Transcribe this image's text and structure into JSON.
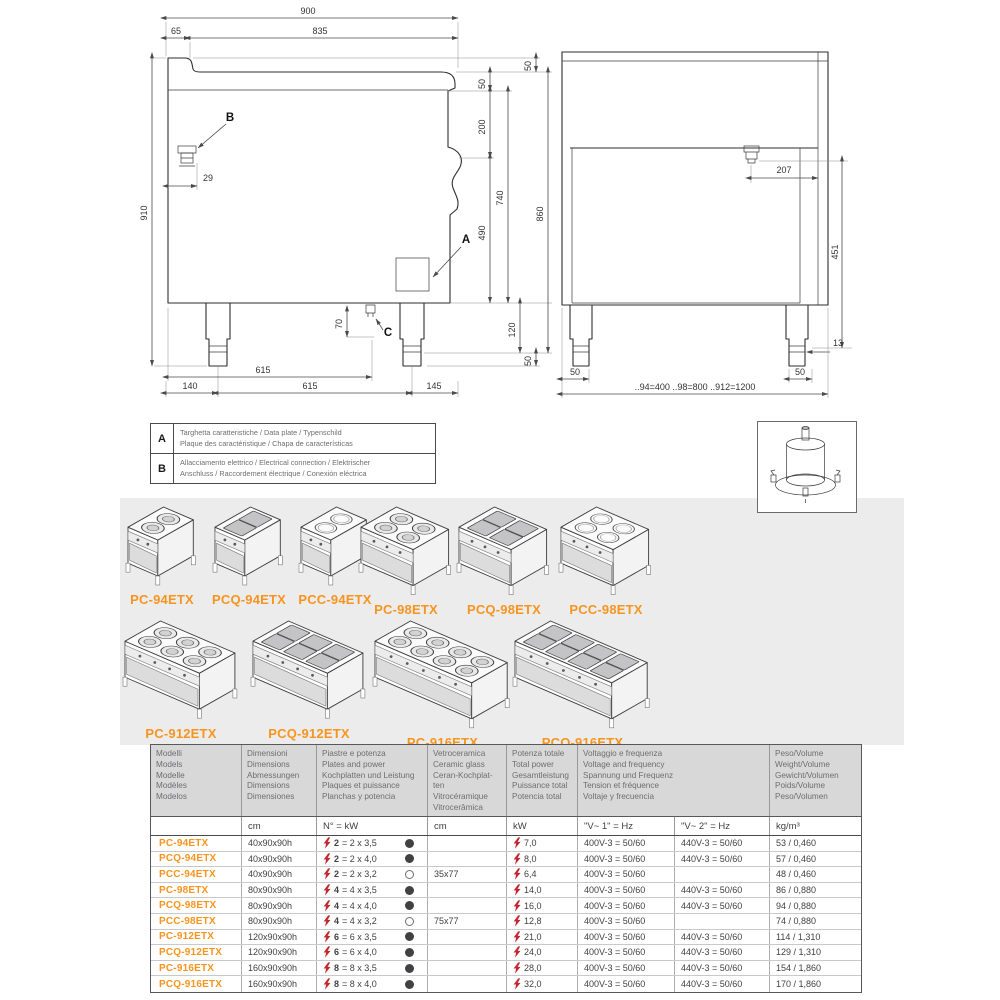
{
  "drawing_left": {
    "dim_900": "900",
    "dim_65": "65",
    "dim_835": "835",
    "dim_910": "910",
    "dim_50_top": "50",
    "dim_50_front": "50",
    "dim_200": "200",
    "dim_490": "490",
    "dim_740": "740",
    "dim_860": "860",
    "dim_120": "120",
    "dim_50_bottom": "50",
    "dim_29": "29",
    "dim_70": "70",
    "dim_615_inner": "615",
    "dim_140": "140",
    "dim_615": "615",
    "dim_145": "145",
    "label_a": "A",
    "label_b": "B",
    "label_c": "C"
  },
  "drawing_right": {
    "dim_207": "207",
    "dim_451": "451",
    "dim_13": "13",
    "dim_50_left": "50",
    "dim_50_right": "50",
    "dim_widths": "..94=400 ..98=800 ..912=1200"
  },
  "legend": {
    "rows": [
      {
        "key": "A",
        "line1": "Targhetta caratteristiche / Data plate / Typenschild",
        "line2": "Plaque des caractéristique / Chapa de características"
      },
      {
        "key": "B",
        "line1": "Allacciamento elettrico / Electrical connection / Elektrischer",
        "line2": "Anschluss / Raccordement électrique / Conexión eléctrica"
      }
    ]
  },
  "products": {
    "row1": [
      {
        "name": "PC-94ETX",
        "cols": 1,
        "shape": "round"
      },
      {
        "name": "PCQ-94ETX",
        "cols": 1,
        "shape": "square"
      },
      {
        "name": "PCC-94ETX",
        "cols": 1,
        "shape": "ceramic"
      },
      {
        "name": "PC-98ETX",
        "cols": 2,
        "shape": "round"
      },
      {
        "name": "PCQ-98ETX",
        "cols": 2,
        "shape": "square"
      },
      {
        "name": "PCC-98ETX",
        "cols": 2,
        "shape": "ceramic"
      }
    ],
    "row2": [
      {
        "name": "PC-912ETX",
        "cols": 3,
        "shape": "round"
      },
      {
        "name": "PCQ-912ETX",
        "cols": 3,
        "shape": "square"
      },
      {
        "name": "PC-916ETX",
        "cols": 4,
        "shape": "round"
      },
      {
        "name": "PCQ-916ETX",
        "cols": 4,
        "shape": "square"
      }
    ]
  },
  "table": {
    "headers": {
      "models": "Modelli\nModels\nModelle\nModèles\nModelos",
      "dimensions": "Dimensioni\nDimensions\nAbmessungen\nDimensions\nDimensiones",
      "plates": "Piastre e potenza\nPlates and power\nKochplatten und Leistung\nPlaques et puissance\nPlanchas y potencia",
      "ceramic": "Vetroceramica\nCeramic glass\nCeran-Kochplat-\nten\nVitrocéramique\nVitrocerâmica",
      "power": "Potenza totale\nTotal power\nGesamtleistung\nPuissance total\nPotencia total",
      "voltage": "Voltaggio e frequenza\nVoltage and frequency\nSpannung und Frequenz\nTension et fréquence\nVoltaje y frecuencia",
      "weight": "Peso/Volume\nWeight/Volume\nGewicht/Volumen\nPoids/Volume\nPeso/Volumen"
    },
    "units": {
      "model": "",
      "dim": "cm",
      "plates": "N° = kW",
      "ceramic": "cm",
      "power": "kW",
      "v1": "\"V~ 1\" = Hz",
      "v2": "\"V~ 2\" = Hz",
      "weight": "kg/m³"
    },
    "rows": [
      {
        "model": "PC-94ETX",
        "dim": "40x90x90h",
        "plates_n": "2",
        "plates_detail": "= 2 x 3,5",
        "plate_type": "filled",
        "ceramic": "",
        "power": "7,0",
        "v1": "400V-3 = 50/60",
        "v2": "440V-3 = 50/60",
        "weight": "53 / 0,460"
      },
      {
        "model": "PCQ-94ETX",
        "dim": "40x90x90h",
        "plates_n": "2",
        "plates_detail": "= 2 x 4,0",
        "plate_type": "filled",
        "ceramic": "",
        "power": "8,0",
        "v1": "400V-3 = 50/60",
        "v2": "440V-3 = 50/60",
        "weight": "57 / 0,460"
      },
      {
        "model": "PCC-94ETX",
        "dim": "40x90x90h",
        "plates_n": "2",
        "plates_detail": "= 2 x 3,2",
        "plate_type": "open",
        "ceramic": "35x77",
        "power": "6,4",
        "v1": "400V-3 = 50/60",
        "v2": "",
        "weight": "48 / 0,460"
      },
      {
        "model": "PC-98ETX",
        "dim": "80x90x90h",
        "plates_n": "4",
        "plates_detail": "= 4 x 3,5",
        "plate_type": "filled",
        "ceramic": "",
        "power": "14,0",
        "v1": "400V-3 = 50/60",
        "v2": "440V-3 = 50/60",
        "weight": "86 / 0,880"
      },
      {
        "model": "PCQ-98ETX",
        "dim": "80x90x90h",
        "plates_n": "4",
        "plates_detail": "= 4 x 4,0",
        "plate_type": "filled",
        "ceramic": "",
        "power": "16,0",
        "v1": "400V-3 = 50/60",
        "v2": "440V-3 = 50/60",
        "weight": "94 / 0,880"
      },
      {
        "model": "PCC-98ETX",
        "dim": "80x90x90h",
        "plates_n": "4",
        "plates_detail": "= 4 x 3,2",
        "plate_type": "open",
        "ceramic": "75x77",
        "power": "12,8",
        "v1": "400V-3 = 50/60",
        "v2": "",
        "weight": "74 / 0,880"
      },
      {
        "model": "PC-912ETX",
        "dim": "120x90x90h",
        "plates_n": "6",
        "plates_detail": "= 6 x 3,5",
        "plate_type": "filled",
        "ceramic": "",
        "power": "21,0",
        "v1": "400V-3 = 50/60",
        "v2": "440V-3 = 50/60",
        "weight": "114 / 1,310"
      },
      {
        "model": "PCQ-912ETX",
        "dim": "120x90x90h",
        "plates_n": "6",
        "plates_detail": "= 6 x 4,0",
        "plate_type": "filled",
        "ceramic": "",
        "power": "24,0",
        "v1": "400V-3 = 50/60",
        "v2": "440V-3 = 50/60",
        "weight": "129 / 1,310"
      },
      {
        "model": "PC-916ETX",
        "dim": "160x90x90h",
        "plates_n": "8",
        "plates_detail": "= 8 x 3,5",
        "plate_type": "filled",
        "ceramic": "",
        "power": "28,0",
        "v1": "400V-3 = 50/60",
        "v2": "440V-3 = 50/60",
        "weight": "154 / 1,860"
      },
      {
        "model": "PCQ-916ETX",
        "dim": "160x90x90h",
        "plates_n": "8",
        "plates_detail": "= 8 x 4,0",
        "plate_type": "filled",
        "ceramic": "",
        "power": "32,0",
        "v1": "400V-3 = 50/60",
        "v2": "440V-3 = 50/60",
        "weight": "170 / 1,860"
      }
    ]
  },
  "colors": {
    "accent_orange": "#f7941e",
    "bolt_red": "#c1272d",
    "header_gray": "#d8d8d8",
    "band_gray": "#ececec"
  }
}
